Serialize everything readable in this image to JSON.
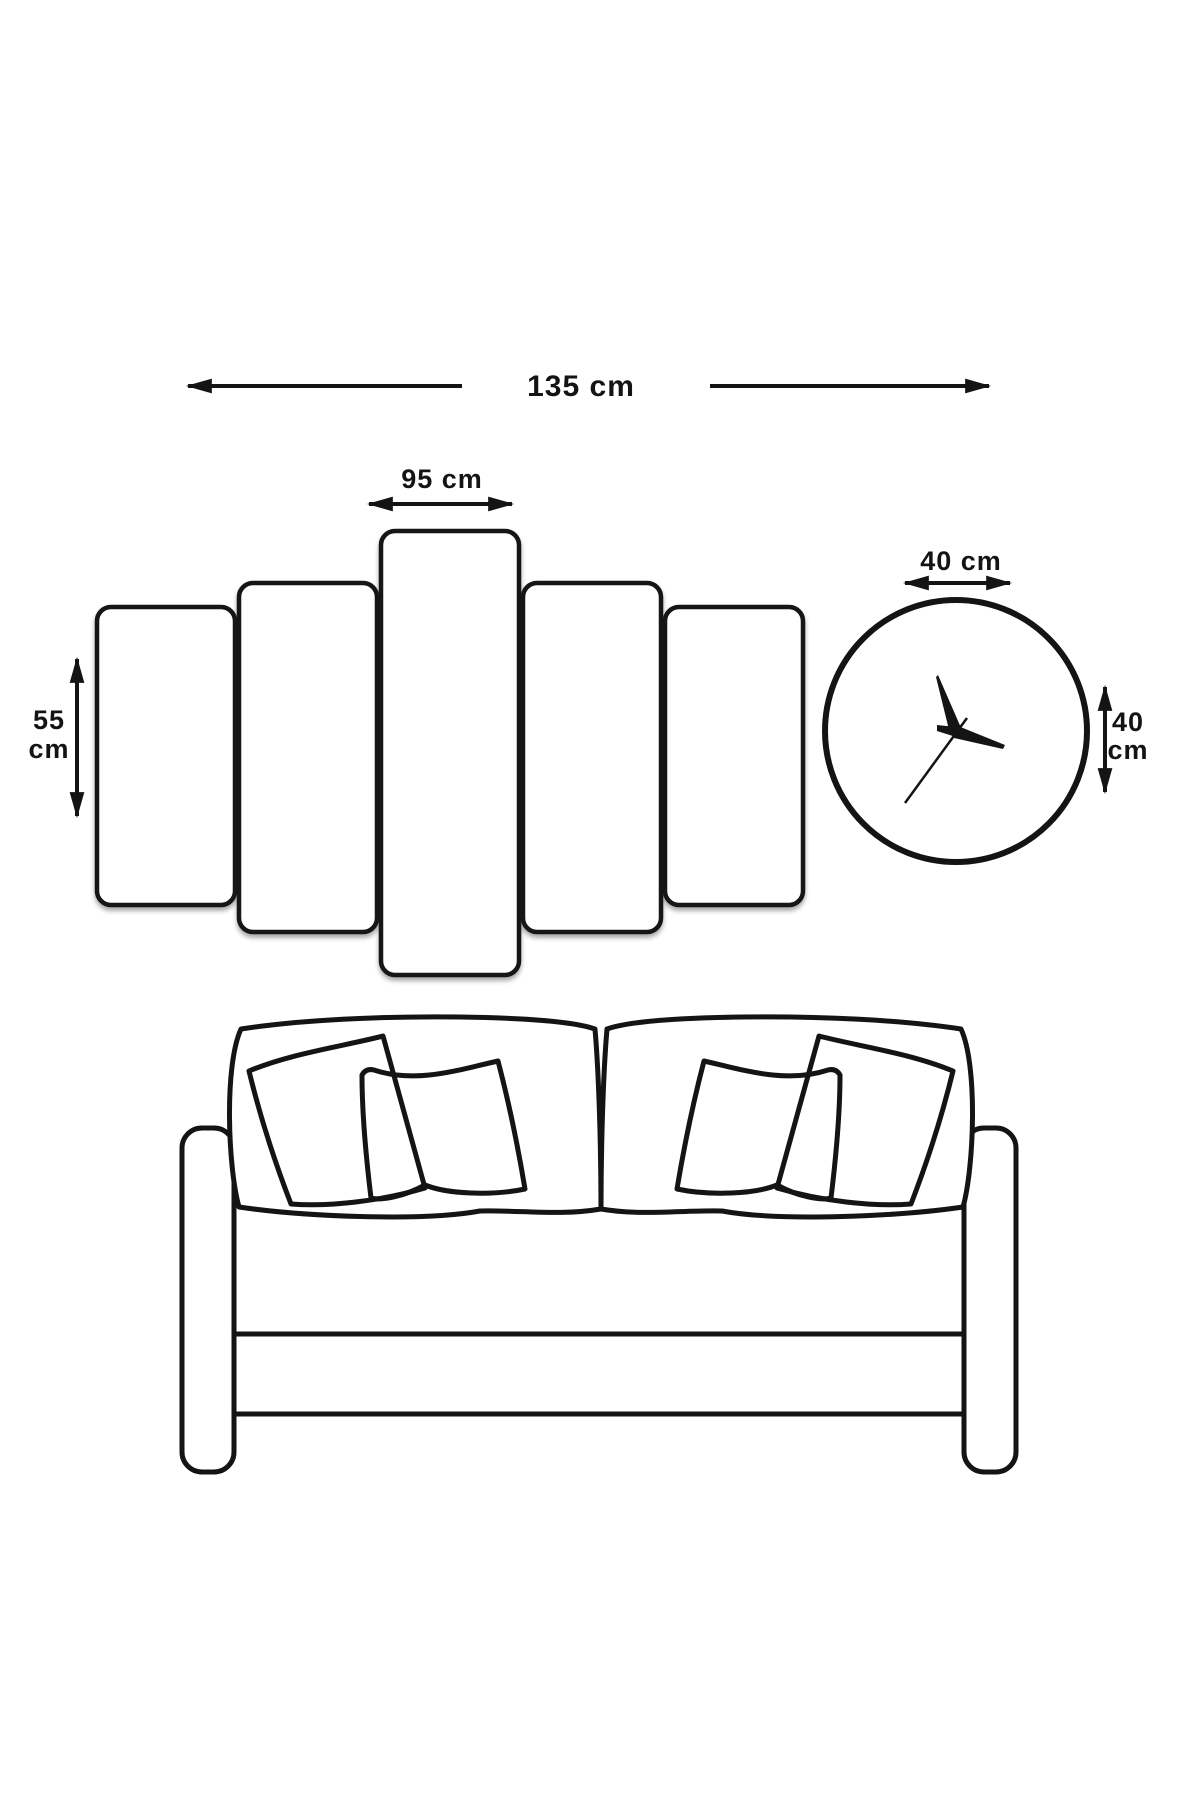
{
  "colors": {
    "background": "#ffffff",
    "line": "#141414"
  },
  "panel_set": {
    "total_width": {
      "label": "135 cm"
    },
    "center_panel_width": {
      "label": "95 cm"
    },
    "side_panel_height": {
      "line1": "55",
      "line2": "cm"
    },
    "panel_count": 5
  },
  "clock": {
    "width": {
      "label": "40 cm"
    },
    "height": {
      "line1": "40",
      "line2": "cm"
    }
  }
}
